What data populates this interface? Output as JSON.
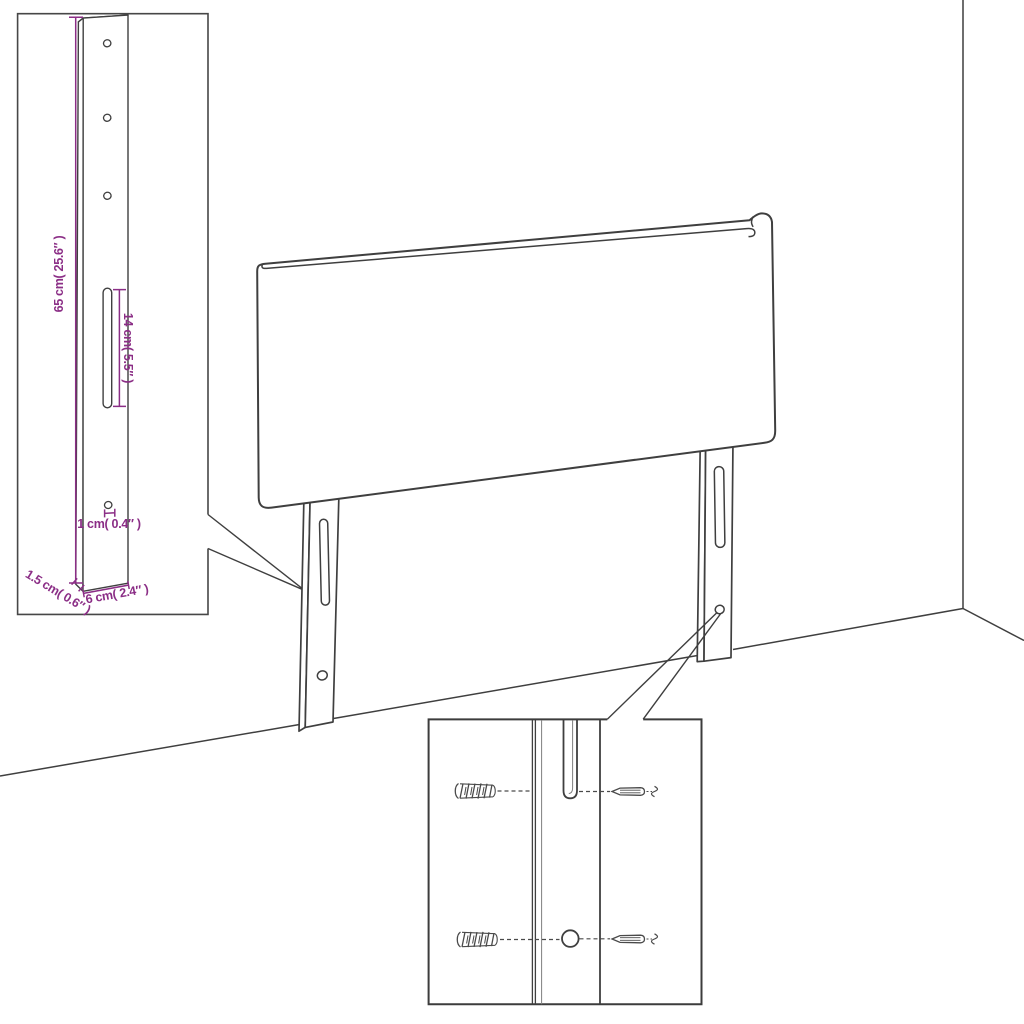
{
  "colors": {
    "background": "#ffffff",
    "line": "#3f3f3f",
    "dimension": "#8B2E86",
    "inset_border": "#474747",
    "detail_border": "#3c3c3c"
  },
  "dimension_labels": {
    "bracket_height": "65 cm( 25.6″ )",
    "slot_length": "14 cm( 5.5″ )",
    "hole_diameter": "1 cm( 0.4″ )",
    "bracket_thickness": "1.5 cm( 0.6″ )",
    "bracket_width": "6 cm( 2.4″ )"
  }
}
